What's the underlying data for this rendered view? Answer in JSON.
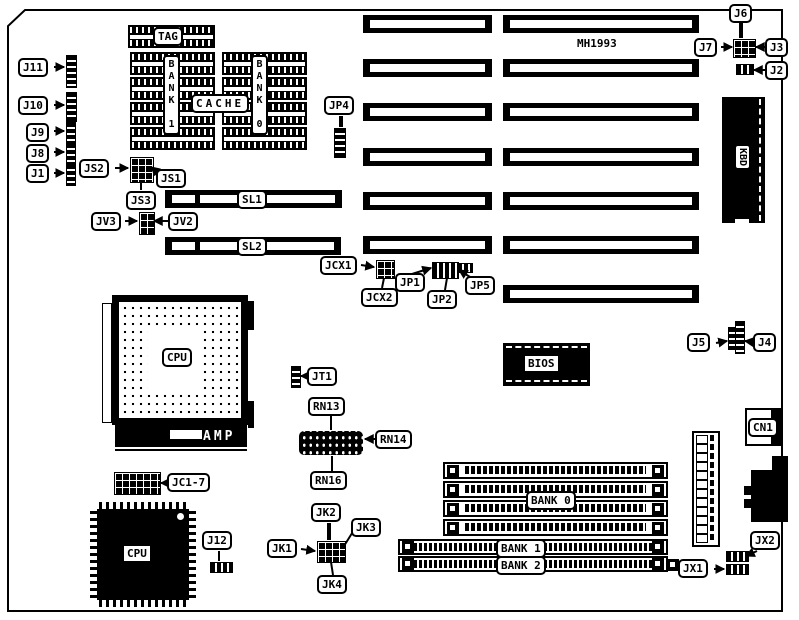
{
  "board": {
    "title": "MH1993",
    "colors": {
      "foreground": "#000000",
      "background": "#ffffff"
    }
  },
  "labels": {
    "j11": "J11",
    "j10": "J10",
    "j9": "J9",
    "j8": "J8",
    "j1": "J1",
    "js2": "JS2",
    "js1": "JS1",
    "js3": "JS3",
    "jv3": "JV3",
    "jv2": "JV2",
    "tag": "TAG",
    "cache": "CACHE",
    "bank1_cache": "BANK 1",
    "bank0_cache": "BANK 0",
    "sl1": "SL1",
    "sl2": "SL2",
    "jp4": "JP4",
    "jcx1": "JCX1",
    "jcx2": "JCX2",
    "jp1": "JP1",
    "jp2": "JP2",
    "jp5": "JP5",
    "j6": "J6",
    "j7": "J7",
    "j3": "J3",
    "j2": "J2",
    "kbd": "KBD",
    "j5": "J5",
    "j4": "J4",
    "bios": "BIOS",
    "cn1": "CN1",
    "cpu_socket": "CPU",
    "amp": "AMP",
    "jt1": "JT1",
    "rn13": "RN13",
    "rn14": "RN14",
    "rn16": "RN16",
    "jc17": "JC1-7",
    "cpu_qfp": "CPU",
    "j12": "J12",
    "jk1": "JK1",
    "jk2": "JK2",
    "jk3": "JK3",
    "jk4": "JK4",
    "bank0": "BANK 0",
    "bank1": "BANK 1",
    "bank2": "BANK 2",
    "jx1": "JX1",
    "jx2": "JX2"
  }
}
